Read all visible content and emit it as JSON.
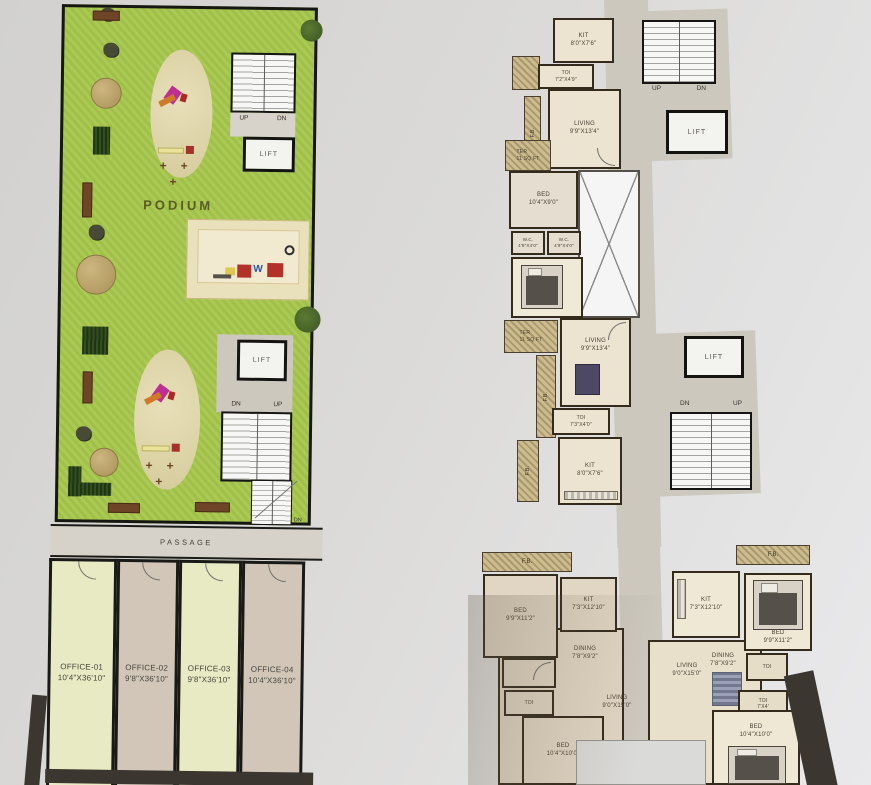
{
  "podium": {
    "title": "PODIUM",
    "passage": "PASSAGE",
    "lift": "LIFT",
    "up": "UP",
    "dn": "DN",
    "offices": [
      {
        "name": "OFFICE-01",
        "dims": "10'4\"X36'10\""
      },
      {
        "name": "OFFICE-02",
        "dims": "9'8\"X36'10\""
      },
      {
        "name": "OFFICE-03",
        "dims": "9'8\"X36'10\""
      },
      {
        "name": "OFFICE-04",
        "dims": "10'4\"X36'10\""
      }
    ]
  },
  "floor": {
    "lift": "LIFT",
    "up": "UP",
    "dn": "DN",
    "fb": "F.B.",
    "upper_rooms": [
      {
        "name": "KIT",
        "dims": "8'0\"X7'6\""
      },
      {
        "name": "TOI",
        "dims": "7'2\"X4'9\""
      },
      {
        "name": "LIVING",
        "dims": "9'9\"X13'4\""
      },
      {
        "name": "TER",
        "dims": "11 SQ FT"
      },
      {
        "name": "BED",
        "dims": "10'4\"X9'0\""
      },
      {
        "name": "W.C.",
        "dims": "4'9\"X4'0\""
      },
      {
        "name": "W.C.",
        "dims": "4'9\"X4'0\""
      },
      {
        "name": "BED",
        "dims": "10'4\"X9'8\""
      },
      {
        "name": "TER",
        "dims": "11 SQ FT"
      },
      {
        "name": "LIVING",
        "dims": "9'9\"X13'4\""
      },
      {
        "name": "TOI",
        "dims": "7'3\"X4'0\""
      },
      {
        "name": "KIT",
        "dims": "8'0\"X7'6\""
      }
    ],
    "lower_rooms": [
      {
        "name": "BED",
        "dims": "9'9\"X11'2\""
      },
      {
        "name": "KIT",
        "dims": "7'3\"X12'10\""
      },
      {
        "name": "KIT",
        "dims": "7'3\"X12'10\""
      },
      {
        "name": "BED",
        "dims": "9'9\"X11'2\""
      },
      {
        "name": "DINING",
        "dims": "7'8\"X9'2\""
      },
      {
        "name": "DINING",
        "dims": "7'8\"X9'2\""
      },
      {
        "name": "LIVING",
        "dims": "9'0\"X15'0\""
      },
      {
        "name": "LIVING",
        "dims": "9'0\"X15'0\""
      },
      {
        "name": "TOI",
        "dims": ""
      },
      {
        "name": "TOI",
        "dims": ""
      },
      {
        "name": "TOI",
        "dims": "7'X4'"
      },
      {
        "name": "BED",
        "dims": "10'4\"X10'0\""
      },
      {
        "name": "BED",
        "dims": "10'4\"X10'0\""
      }
    ]
  }
}
